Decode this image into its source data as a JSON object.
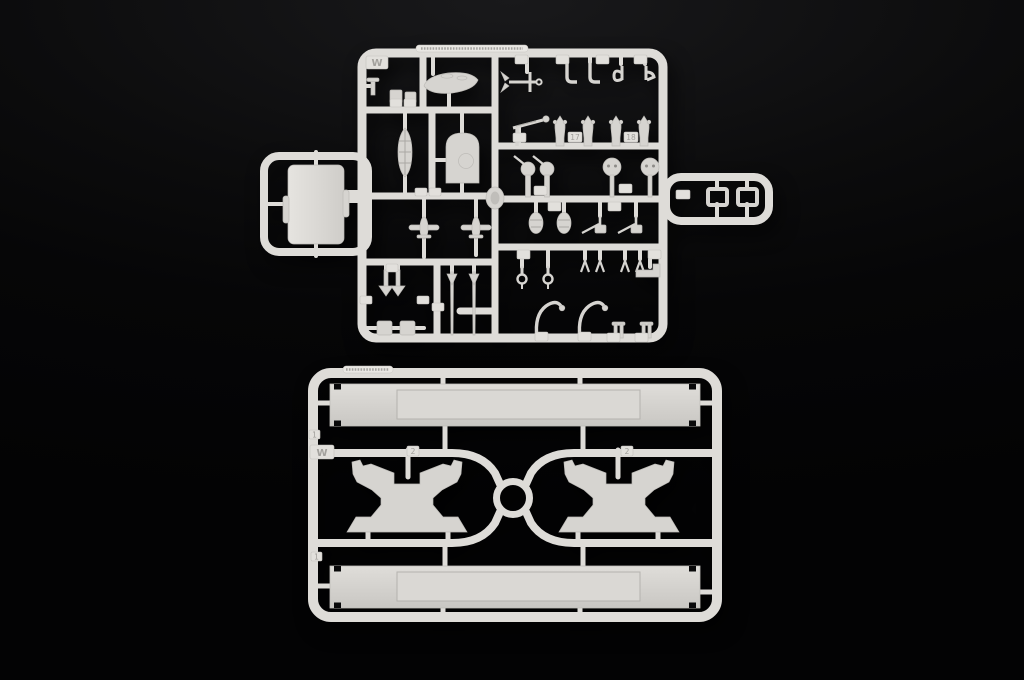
{
  "scene": {
    "type": "photograph",
    "subject": "Two light-grey injection-moulded plastic model-kit sprues (runner frames with ship parts) photographed on a black background",
    "background_color": "#060607",
    "plastic_color": "#dedcd8",
    "panel_plastic_color": "#d2d0cc",
    "shadow": "soft dark drop shadow under both sprues"
  },
  "top_sprue": {
    "description": "Detail-parts sprue with left and right side arms, dense grid of small ship fittings",
    "gate_label": "W",
    "part_number_tabs": [
      "17",
      "18"
    ],
    "other_tabs": "many small embossed number tabs, illegible at this scale",
    "molded_text_legible": false,
    "parts": [
      "motor launch hull",
      "open whaleboat",
      "arched bulkhead panel with round boss",
      "superstructure block (left arm)",
      "oval life-raft disc at centre junction",
      "stocked anchor",
      "2 J-shaped boat davits",
      "2 chain-stopper fittings",
      "crane jib with ball tip",
      "4 single AA gun mounts",
      "2 shielded machine guns",
      "2 round platform discs with twin holes",
      "2 paravanes",
      "2 twin gun mounts",
      "2 pulley davits",
      "4 forked stanchions",
      "stepped platform plate",
      "2 curved boat davits",
      "2 mooring bitts",
      "2 float-plane / propeller pieces",
      "2 arrowhead mast sections",
      "2 long tapered mast poles",
      "small deck blocks and boxes",
      "2 rectangular hatch frames (right arm)"
    ]
  },
  "bottom_sprue": {
    "description": "Display-stand sprue: two long base rails, two mirrored hull-cradle brackets, central ring runner",
    "gate_label": "W",
    "number_tabs": [
      "1",
      "2",
      "2",
      "1"
    ],
    "molded_text_legible": false,
    "parts": [
      "long display-stand base rail (top)",
      "long display-stand base rail (bottom)",
      "hull cradle bracket (left)",
      "hull cradle bracket (right)",
      "central ring runner with X-shaped curved runners"
    ]
  }
}
